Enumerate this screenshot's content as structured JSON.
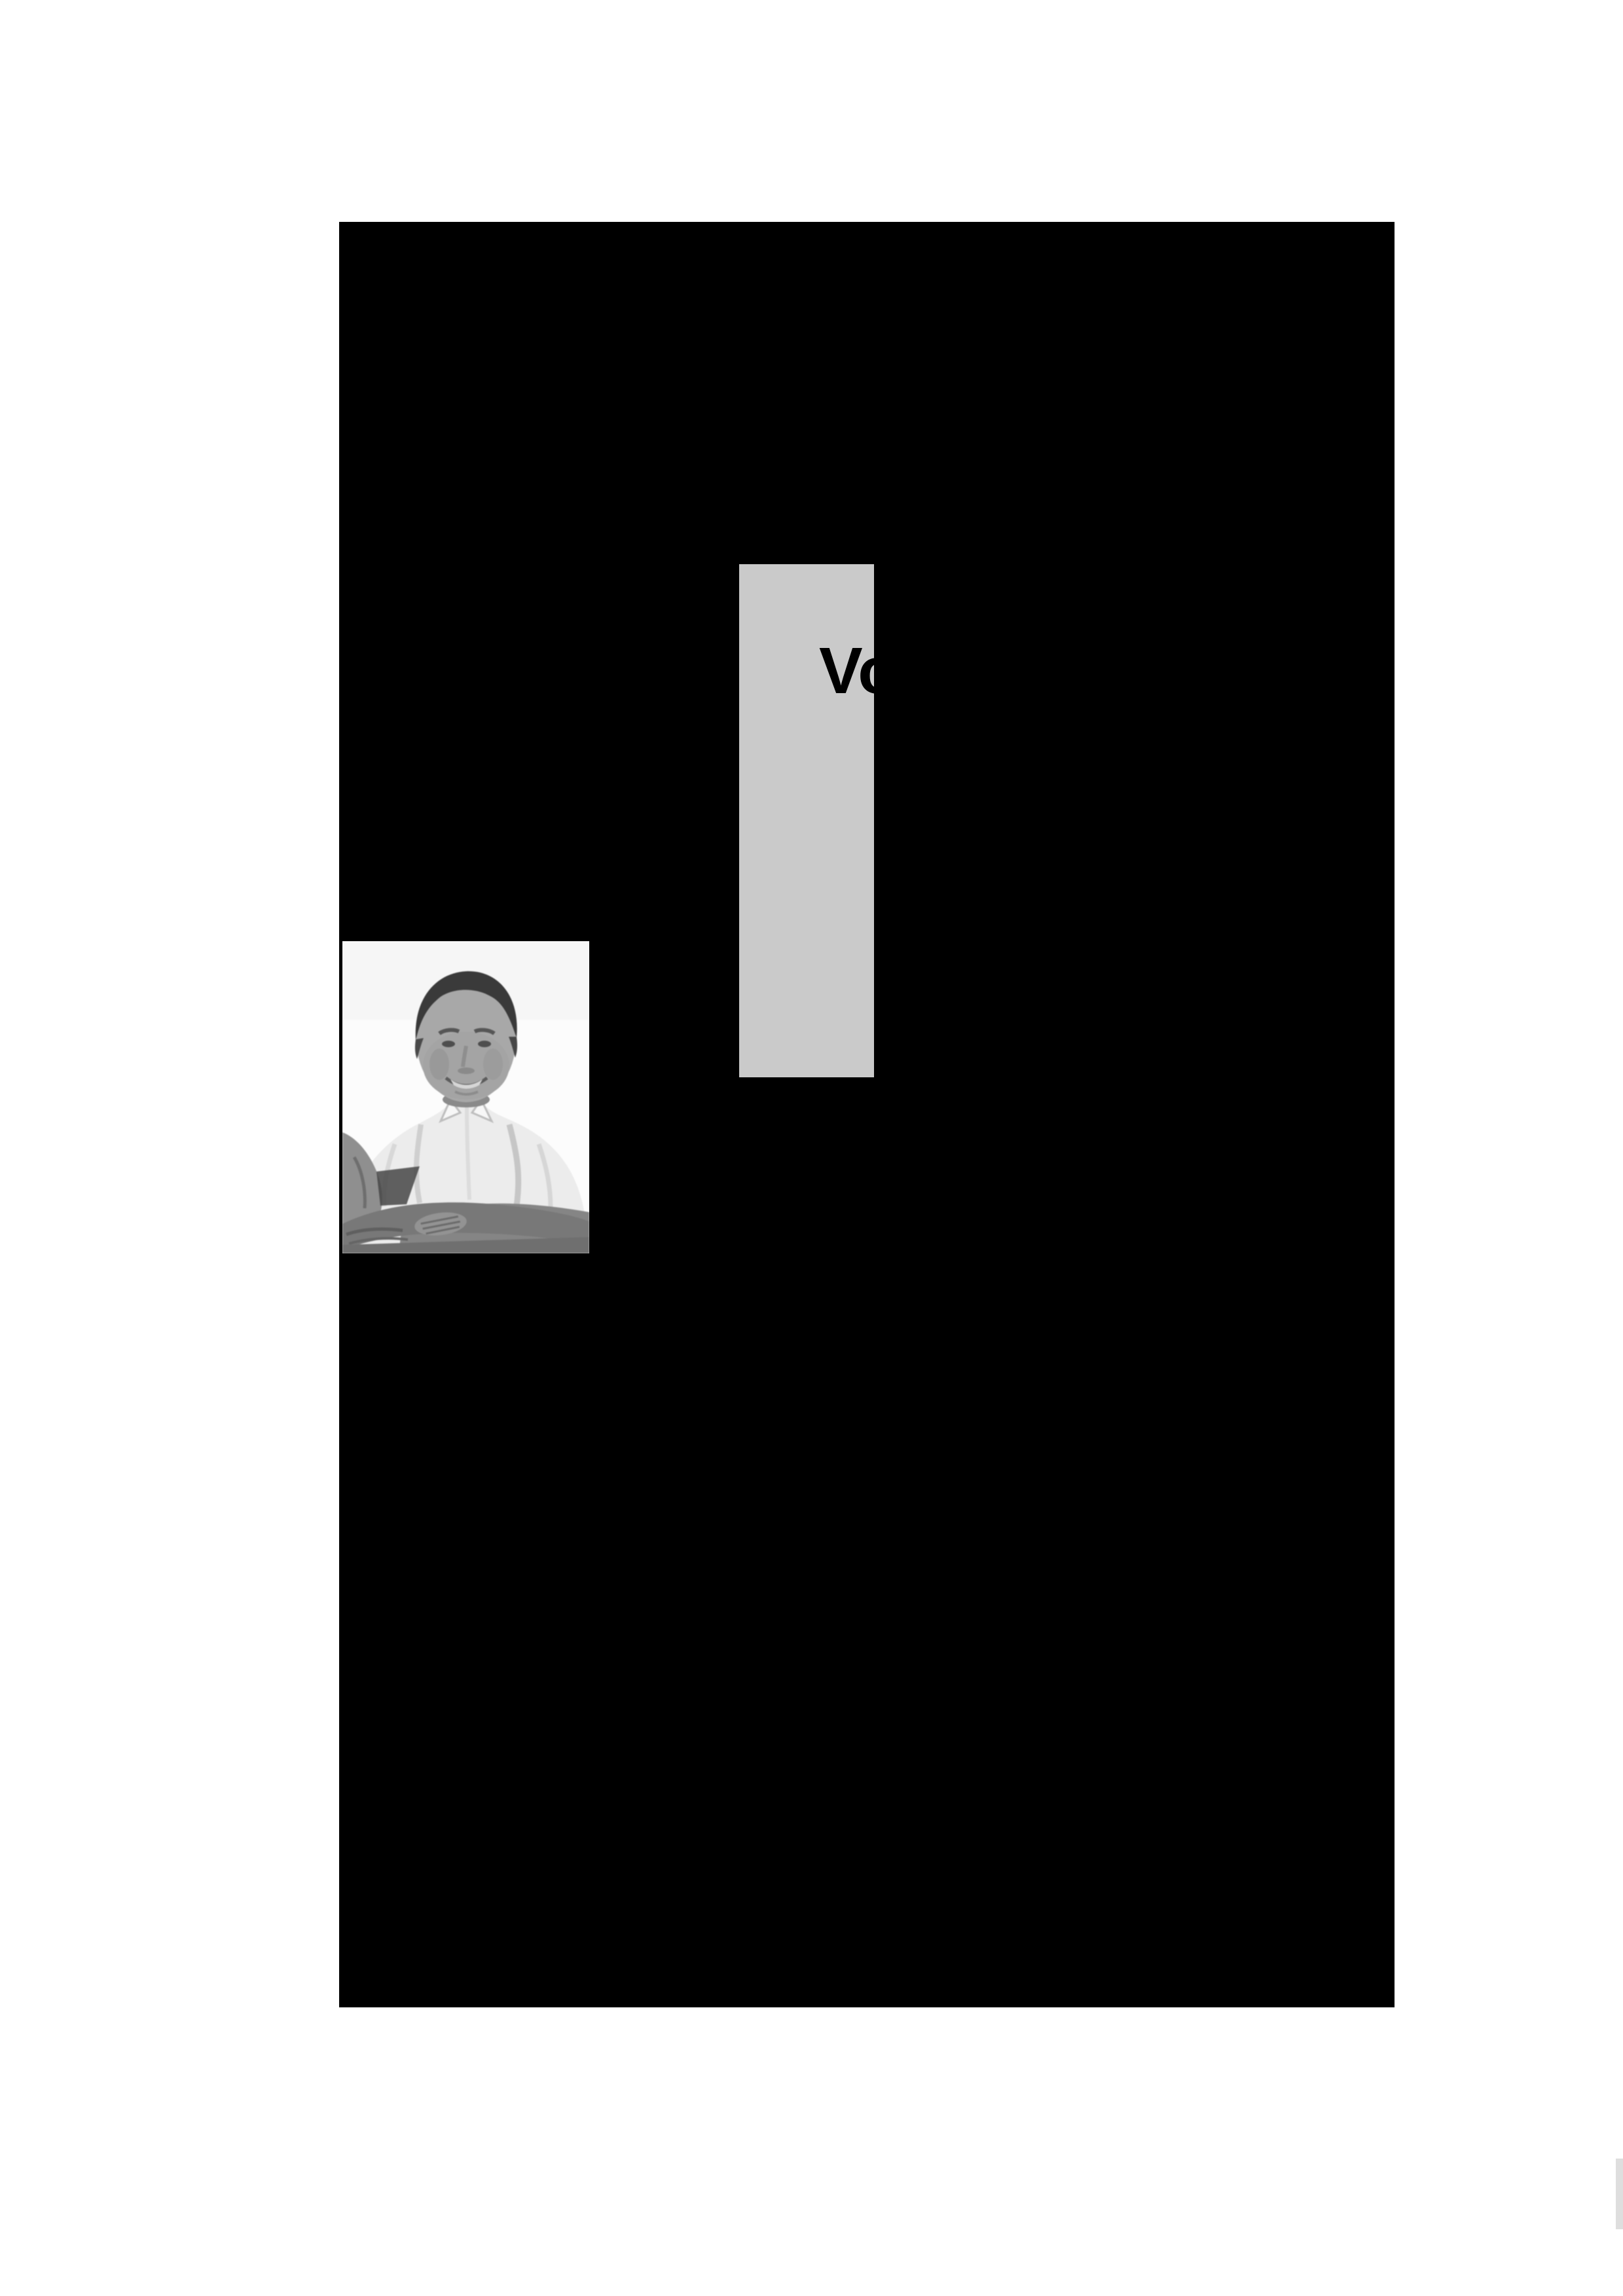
{
  "document": {
    "title_visible": "Vo",
    "page_number": "11"
  },
  "photo": {
    "name": "grayscale-portrait-of-man",
    "description": "black-and-white photo of a smiling man with short dark hair wearing a light collared shirt, arms crossed",
    "background": "#ffffff"
  },
  "colors": {
    "canvas_bg": "#ffffff",
    "page_bg": "#000000",
    "title_band_gray": "#cacaca",
    "corner_gray": "#dedede",
    "title_text": "#000000",
    "page_number_text": "#000000"
  }
}
